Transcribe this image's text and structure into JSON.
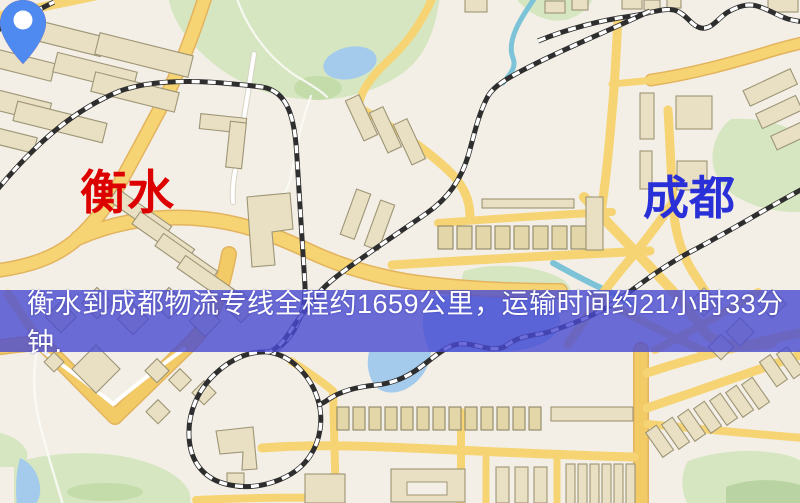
{
  "banner": {
    "text": "衡水到成都物流专线全程约1659公里，运输时间约21小时33分钟.",
    "background_color": "#484ad2",
    "text_color": "#ffffff"
  },
  "markers": {
    "origin": {
      "label": "衡水",
      "pin_color": "#ec0b0b",
      "label_color": "#dd0000"
    },
    "destination": {
      "label": "成都",
      "pin_color": "#4e8af0",
      "label_color": "#2a30d8"
    }
  },
  "map": {
    "palette": {
      "background": "#f3efe6",
      "road_major": "#f6d474",
      "road_casing": "#e3b35e",
      "building": "#e9dfc2",
      "building_outline": "#9d9576",
      "park_green": "#d5e6c0",
      "water_blue": "#a5cbec",
      "railway_dark": "#2e2e2e"
    }
  }
}
